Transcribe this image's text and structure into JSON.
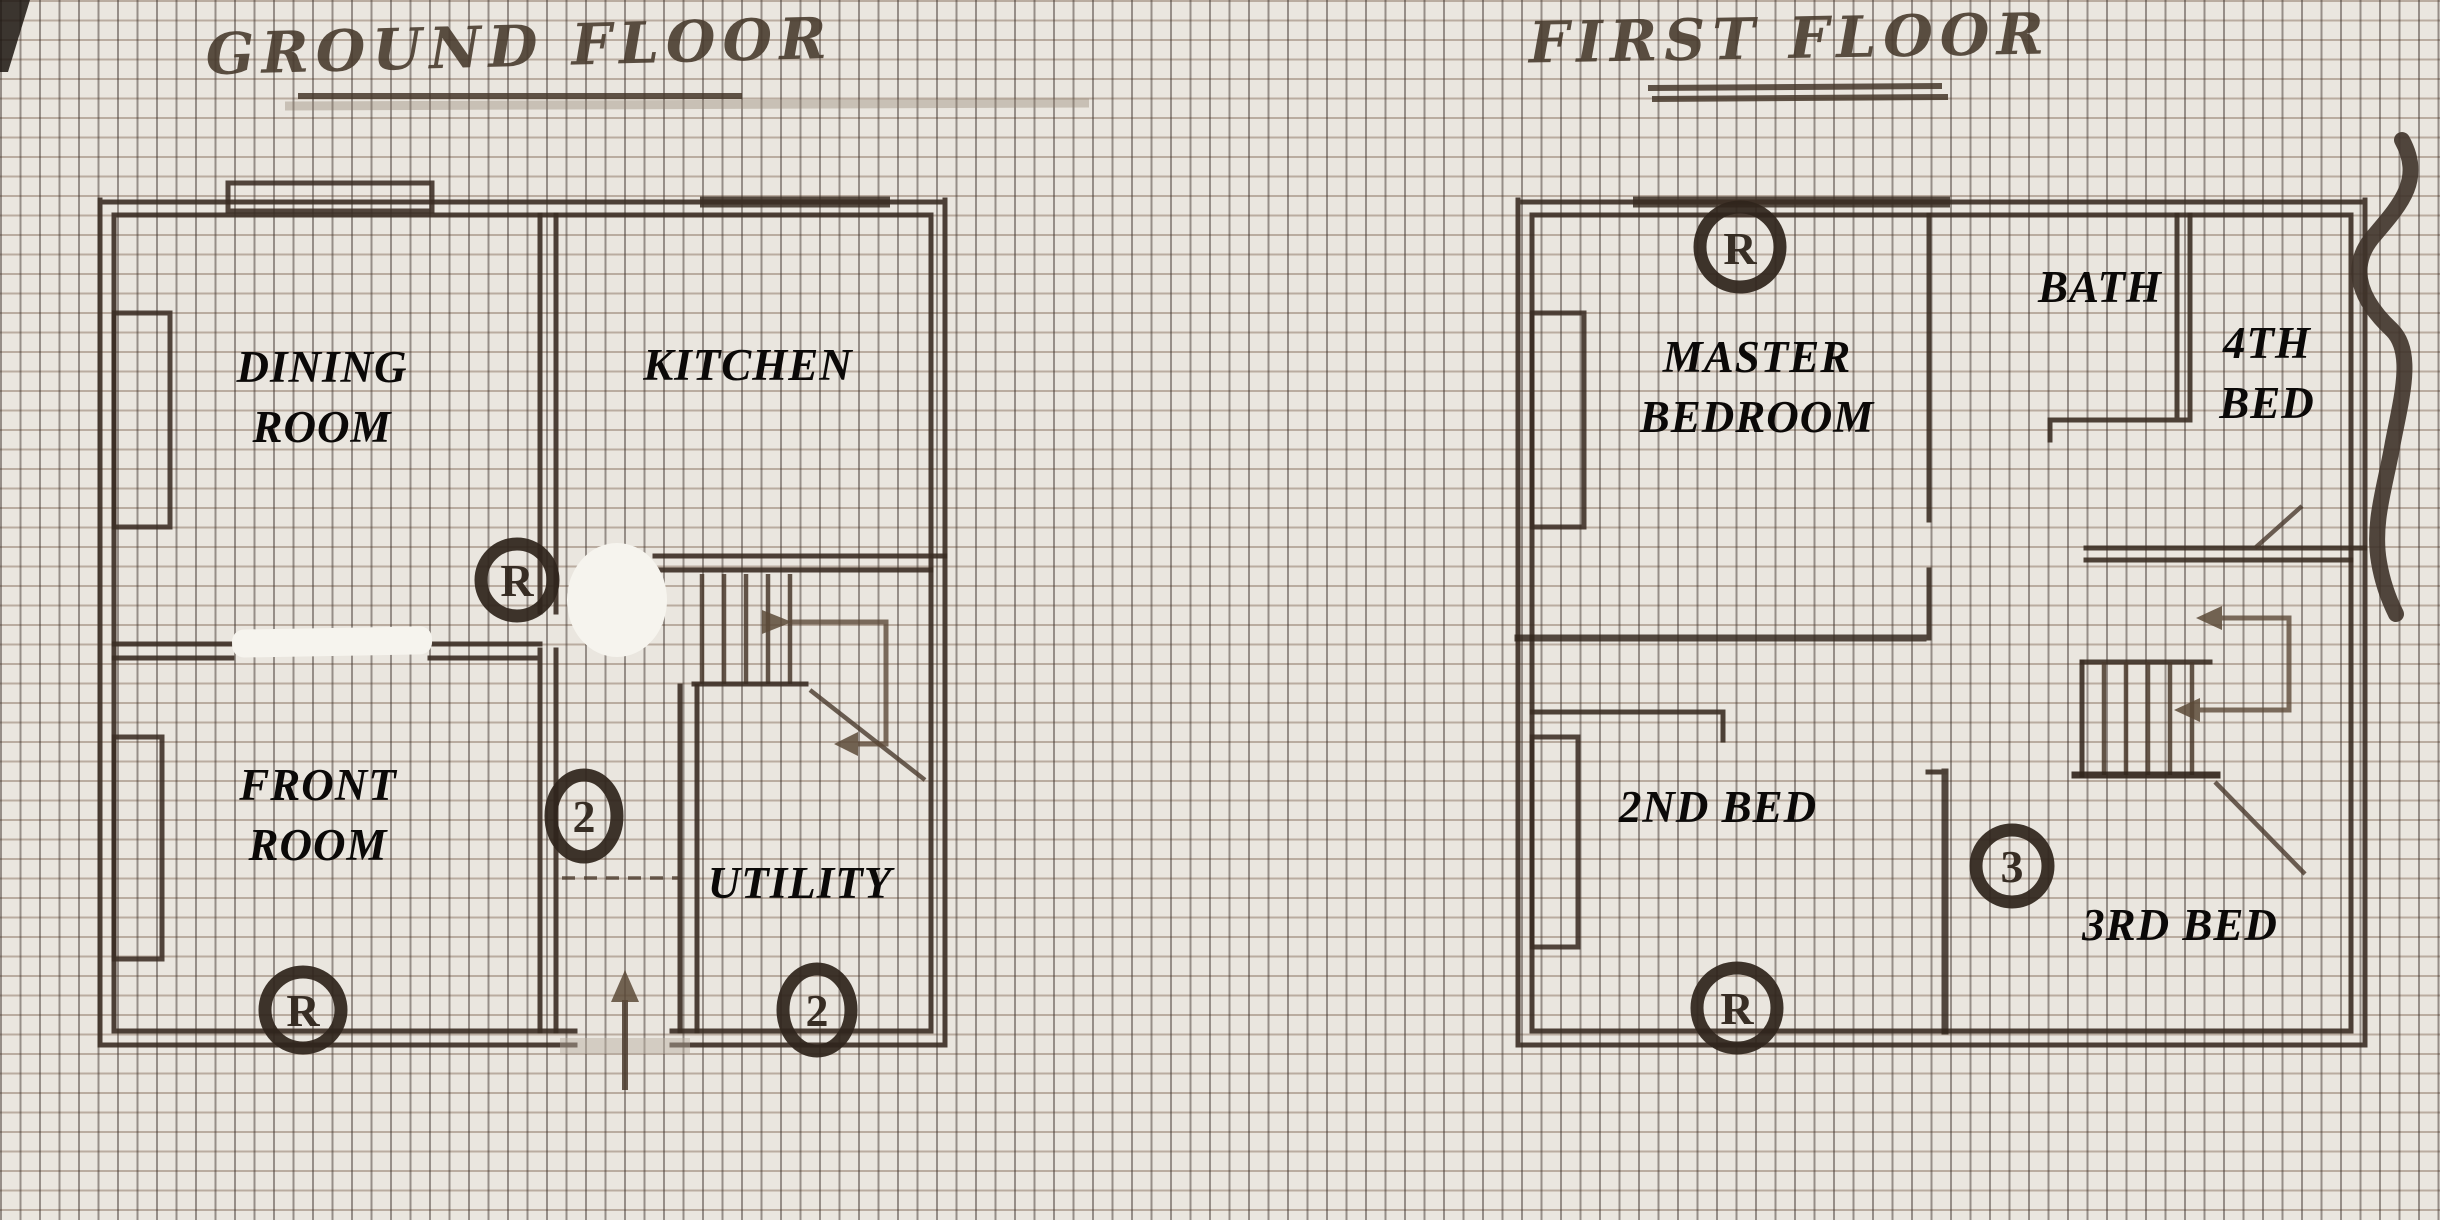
{
  "document": {
    "type": "hand-drawn floor plan sketch",
    "medium": "marker pen on graph paper, printed room labels"
  },
  "ground_floor": {
    "title": "GROUND FLOOR",
    "rooms": {
      "dining": {
        "line1": "DINING",
        "line2": "ROOM"
      },
      "kitchen": {
        "line1": "KITCHEN"
      },
      "front": {
        "line1": "FRONT",
        "line2": "ROOM"
      },
      "utility": {
        "line1": "UTILITY"
      }
    },
    "markers": [
      {
        "letter": "R",
        "location": "kitchen-hall-door"
      },
      {
        "letter": "2",
        "location": "hallway"
      },
      {
        "letter": "R",
        "location": "front-room-bottom"
      },
      {
        "letter": "2",
        "location": "utility-bottom"
      }
    ],
    "entrance_arrow_direction": "up"
  },
  "first_floor": {
    "title": "FIRST FLOOR",
    "rooms": {
      "master": {
        "line1": "MASTER",
        "line2": "BEDROOM"
      },
      "bath": {
        "line1": "BATH"
      },
      "bed4": {
        "line1": "4TH",
        "line2": "BED"
      },
      "bed2": {
        "line1": "2ND BED"
      },
      "bed3": {
        "line1": "3RD BED"
      }
    },
    "markers": [
      {
        "letter": "R",
        "location": "master-bedroom-top"
      },
      {
        "letter": "3",
        "location": "beside-3rd-bed"
      },
      {
        "letter": "R",
        "location": "2nd-bed-bottom"
      }
    ]
  },
  "colors": {
    "paper": "#eae6df",
    "grid_vertical": "#3a2f28",
    "grid_horizontal": "#765c48",
    "ink": "#3b2e24",
    "label_text": "#0b0908"
  }
}
